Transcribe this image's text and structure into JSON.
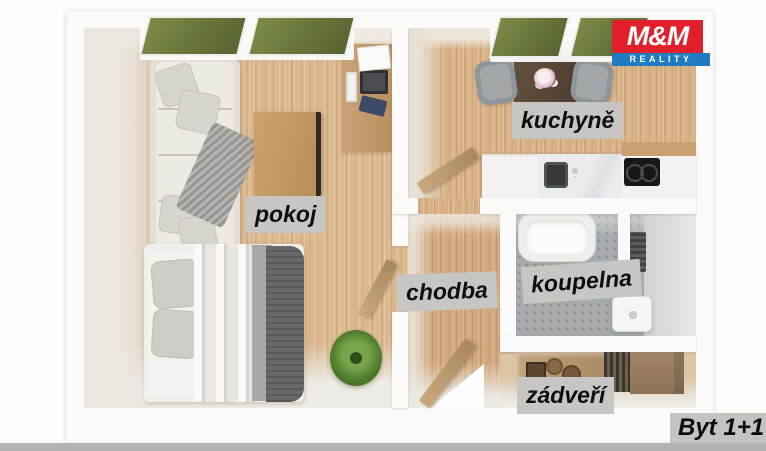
{
  "image_type": "3d-floorplan-render",
  "branding": {
    "name_top": "M&M",
    "name_bottom": "REALITY",
    "logo_red": "#e2202c",
    "logo_blue": "#1f7cc1"
  },
  "title_badge": {
    "text": "Byt 1+1"
  },
  "room_labels": {
    "pokoj": "pokoj",
    "kuchyne": "kuchyně",
    "chodba": "chodba",
    "koupelna": "koupelna",
    "zadveri": "zádveří"
  },
  "label_style": {
    "background": "#c7c6c3",
    "color": "#0e0e0e",
    "style": "bold-italic"
  },
  "palette": {
    "wood_floor": "#d9b488",
    "wall_white": "#fbfaf8",
    "bath_tile_gray": "#a7abad",
    "grass_green": "#6e7b40",
    "page_background": "#ffffff",
    "bottom_bar_gray": "#b1b3b5"
  },
  "window_view": "grass",
  "furniture": {
    "pokoj": [
      "sofa",
      "throw-pillows",
      "gray-throw-blanket",
      "coffee-table",
      "desk",
      "laptop",
      "keyboard",
      "double-bed",
      "bed-pillows",
      "dark-gray-blanket",
      "potted-plant"
    ],
    "kuchyne": [
      "dining-table",
      "flower-vase",
      "chair",
      "chair",
      "kitchen-cabinet",
      "sink",
      "faucet",
      "cooktop",
      "open-door"
    ],
    "chodba": [
      "open-entry-door"
    ],
    "koupelna": [
      "bathtub",
      "radiator",
      "washing-machine",
      "partition-wall"
    ],
    "zadveri": [
      "wooden-bench",
      "shoe-cabinet",
      "baskets",
      "picture-frame"
    ]
  }
}
